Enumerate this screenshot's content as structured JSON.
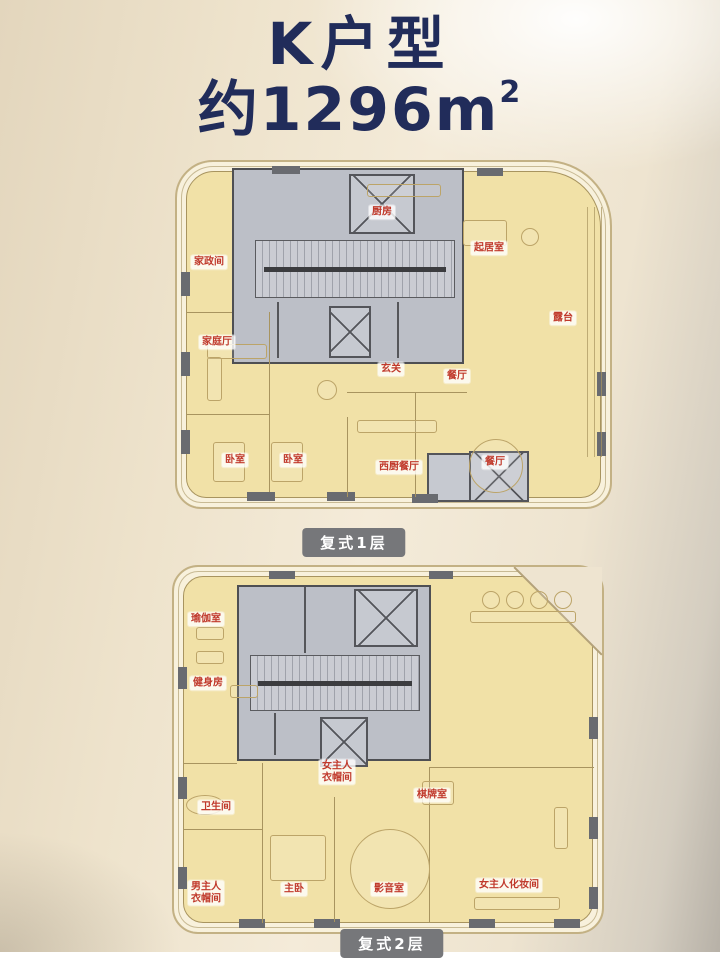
{
  "header": {
    "title": "K户型",
    "area_prefix": "约",
    "area_value": "1296",
    "area_unit": "m",
    "area_exponent": "2",
    "area_full": "约1296m²"
  },
  "colors": {
    "title_navy": "#212c5a",
    "room_fill": "#f1e1a7",
    "core_gray": "#bcbfc7",
    "label_red": "#c0392b",
    "caption_bg": "#76777a"
  },
  "plans": [
    {
      "caption": "复式1层",
      "rooms": [
        {
          "label": "家政间",
          "x": 32,
          "y": 100
        },
        {
          "label": "厨房",
          "x": 205,
          "y": 50
        },
        {
          "label": "起居室",
          "x": 312,
          "y": 86
        },
        {
          "label": "露台",
          "x": 386,
          "y": 156
        },
        {
          "label": "家庭厅",
          "x": 40,
          "y": 180
        },
        {
          "label": "玄关",
          "x": 214,
          "y": 207
        },
        {
          "label": "餐厅",
          "x": 280,
          "y": 214
        },
        {
          "label": "卧室",
          "x": 58,
          "y": 298
        },
        {
          "label": "卧室",
          "x": 116,
          "y": 298
        },
        {
          "label": "西厨餐厅",
          "x": 222,
          "y": 305
        },
        {
          "label": "餐厅",
          "x": 318,
          "y": 300
        }
      ]
    },
    {
      "caption": "复式2层",
      "rooms": [
        {
          "label": "瑜伽室",
          "x": 32,
          "y": 52
        },
        {
          "label": "健身房",
          "x": 34,
          "y": 116
        },
        {
          "label": "女主人\n衣帽间",
          "x": 163,
          "y": 205
        },
        {
          "label": "卫生间",
          "x": 42,
          "y": 240
        },
        {
          "label": "棋牌室",
          "x": 258,
          "y": 228
        },
        {
          "label": "男主人\n衣帽间",
          "x": 32,
          "y": 326
        },
        {
          "label": "主卧",
          "x": 120,
          "y": 322
        },
        {
          "label": "影音室",
          "x": 215,
          "y": 322
        },
        {
          "label": "女主人化妆间",
          "x": 335,
          "y": 318
        }
      ]
    }
  ]
}
